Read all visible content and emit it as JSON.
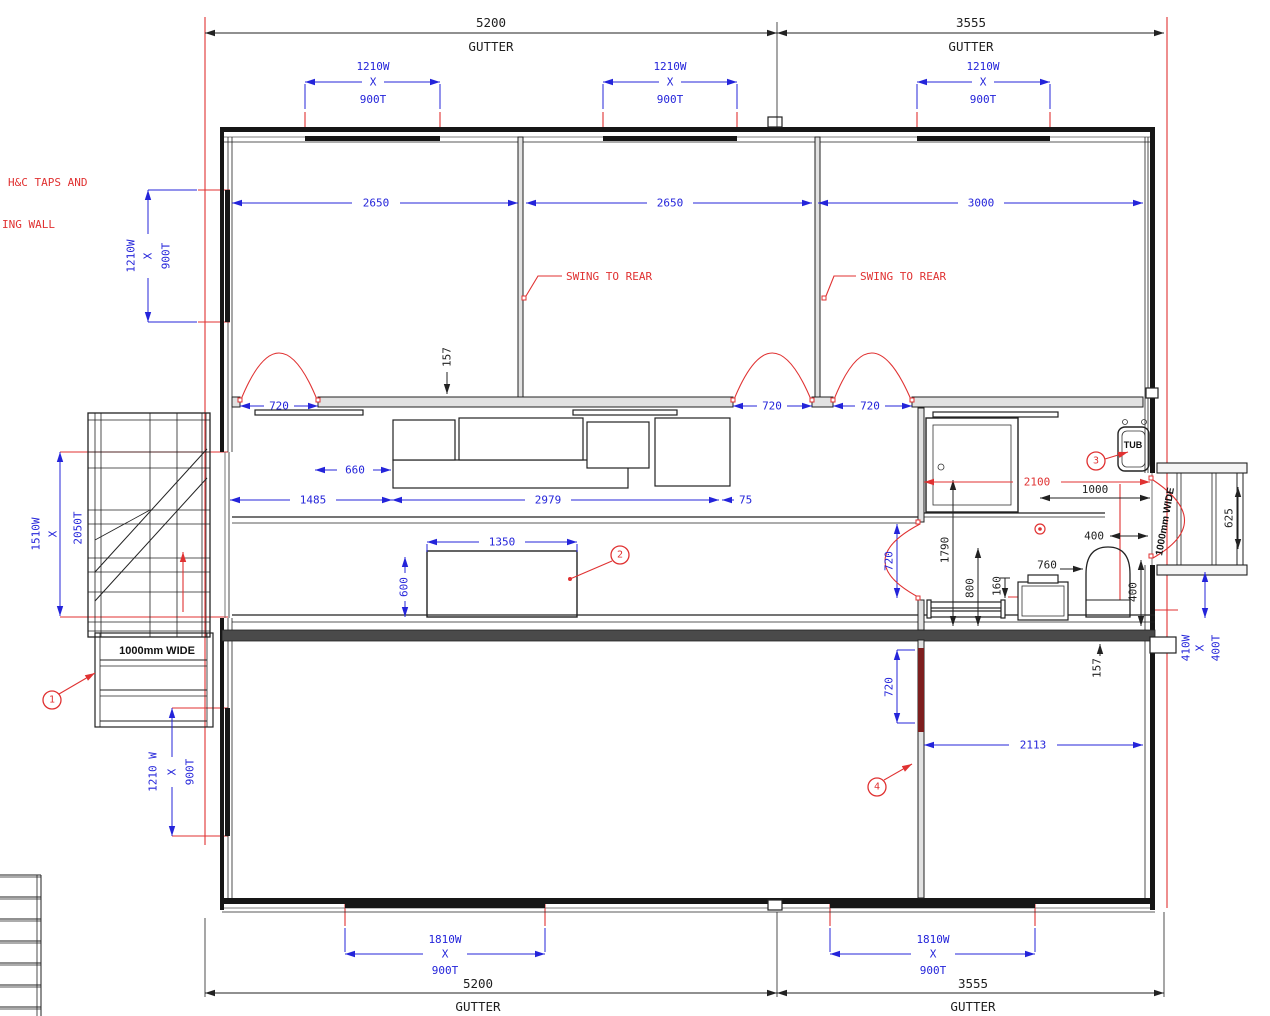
{
  "colors": {
    "dimension_blue": "#2424da",
    "annotation_red": "#e03232",
    "line_black": "#1f1f1f",
    "highlight_wall_red": "#7d1e1e"
  },
  "notes": {
    "taps1": "H&C TAPS AND",
    "taps2": "ING WALL",
    "swing1": "SWING TO REAR",
    "swing2": "SWING TO REAR",
    "tub": "TUB",
    "steps": "1000mm WIDE",
    "side_door": "1000mm WIDE"
  },
  "gutters": {
    "tl_v": "5200",
    "tl_u": "GUTTER",
    "tr_v": "3555",
    "tr_u": "GUTTER",
    "bl_v": "5200",
    "bl_u": "GUTTER",
    "br_v": "3555",
    "br_u": "GUTTER"
  },
  "win": {
    "t1w": "1210W",
    "t1x": "X",
    "t1t": "900T",
    "t2w": "1210W",
    "t2x": "X",
    "t2t": "900T",
    "t3w": "1210W",
    "t3x": "X",
    "t3t": "900T",
    "lw": "1210W",
    "lx": "X",
    "lt": "900T",
    "blw": "1210 W",
    "blx": "X",
    "blt": "900T",
    "b1w": "1810W",
    "b1x": "X",
    "b1t": "900T",
    "b2w": "1810W",
    "b2x": "X",
    "b2t": "900T",
    "rampw": "1510W",
    "rampx": "X",
    "rampt": "2050T",
    "landw": "410W",
    "landx": "X",
    "landt": "400T"
  },
  "dims": {
    "room1": "2650",
    "room2": "2650",
    "room3": "3000",
    "da": "720",
    "db": "720",
    "dc": "720",
    "d660": "660",
    "d1485": "1485",
    "d2979": "2979",
    "d75": "75",
    "d157t": "157",
    "d157b": "157",
    "d1350": "1350",
    "d600": "600",
    "d2100": "2100",
    "d1000": "1000",
    "d400h": "400",
    "d1790": "1790",
    "d800": "800",
    "d160": "160",
    "d760": "760",
    "d400v": "400",
    "d625": "625",
    "dbath": "720",
    "dfront": "720",
    "d2113": "2113"
  },
  "badges": {
    "b1": "1",
    "b2": "2",
    "b3": "3",
    "b4": "4"
  }
}
